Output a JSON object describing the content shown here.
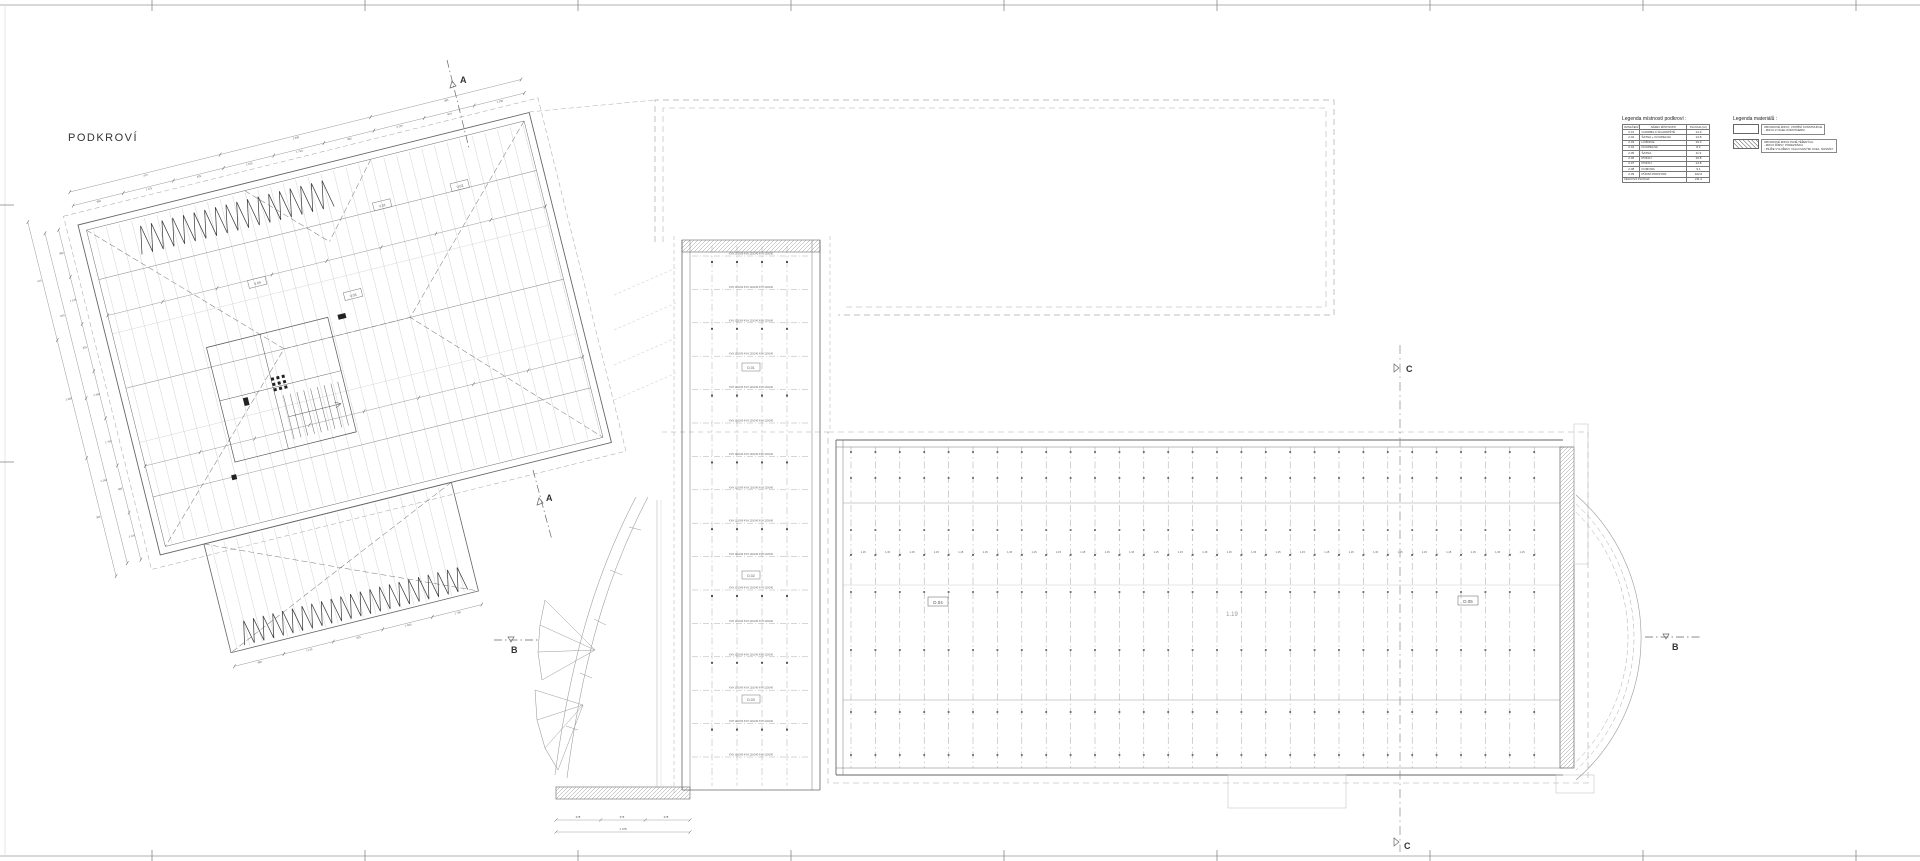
{
  "title": "PODKROVÍ",
  "sections": {
    "a": "A",
    "b": "B",
    "c": "C"
  },
  "legend_rooms": {
    "title": "Legenda místností podkroví :",
    "headers": [
      "OZNAČENÍ",
      "NÁZEV MÍSTNOSTI",
      "PLOCHA [m²]"
    ],
    "rows": [
      [
        "2.01",
        "CHODBA A SCHODIŠTĚ",
        "14.9"
      ],
      [
        "2.02",
        "ŠATNA + KOUPELNA",
        "13.8"
      ],
      [
        "2.03",
        "LOŽNICE",
        "19.3"
      ],
      [
        "2.04",
        "KOUPELNA",
        "8.2"
      ],
      [
        "2.05",
        "ŠATNA",
        "11.9"
      ],
      [
        "2.06",
        "POKOJ",
        "16.8"
      ],
      [
        "2.07",
        "POKOJ",
        "14.8"
      ],
      [
        "2.08",
        "KOMORA",
        "9.1"
      ],
      [
        "2.09",
        "PŮDNÍ PROSTOR",
        "102.6"
      ]
    ],
    "total_label": "CELKOVÁ PLOCHA",
    "total_value": "211.4"
  },
  "legend_materials": {
    "title": "Legenda materiálů :",
    "items": [
      {
        "swatch": "plain",
        "lines": [
          "OBVODOVÉ ZDIVO, VNITŘNÍ KONSTRUKCE",
          "- ZDIVO Z CIHEL POROTHERM"
        ]
      },
      {
        "swatch": "hatch",
        "lines": [
          "OBVODOVÉ ZDIVO PLNĚ TĚŽENÝCH",
          "- ZDIVO ŘÍMSY, PODEZDÍVKA",
          "- PILÍŘE VYLOŽENY VÁLCOVANÝMI OCEL. NOSNÍKY"
        ]
      }
    ]
  },
  "labels": {
    "d01": "D.01",
    "d02": "D.02",
    "d03": "D.03",
    "d04": "D.04",
    "d05": "D.05",
    "room_right": "1.19",
    "v01": "V.01",
    "v02": "V.02",
    "v03": "V.03",
    "v04": "V.04"
  },
  "strip": {
    "joist_text": "KVH 120/240   KVH 120/240   KVH 120/240"
  },
  "right_roof": {
    "spacing_label": "1,15"
  },
  "bottom_dims": [
    "278",
    "376",
    "278"
  ],
  "bottom_dims_total": "1 378",
  "dim_texture": [
    "980",
    "1 125",
    "625",
    "2 450",
    "1 750",
    "900",
    "3 125",
    "615",
    "1 250",
    "475",
    "2 000",
    "365"
  ],
  "colors": {
    "line_main": "#777777",
    "line_wall": "#555555",
    "line_light": "#bbbbbb",
    "line_dashed": "#aaaaaa",
    "text": "#444444",
    "hatch": "#888888"
  }
}
